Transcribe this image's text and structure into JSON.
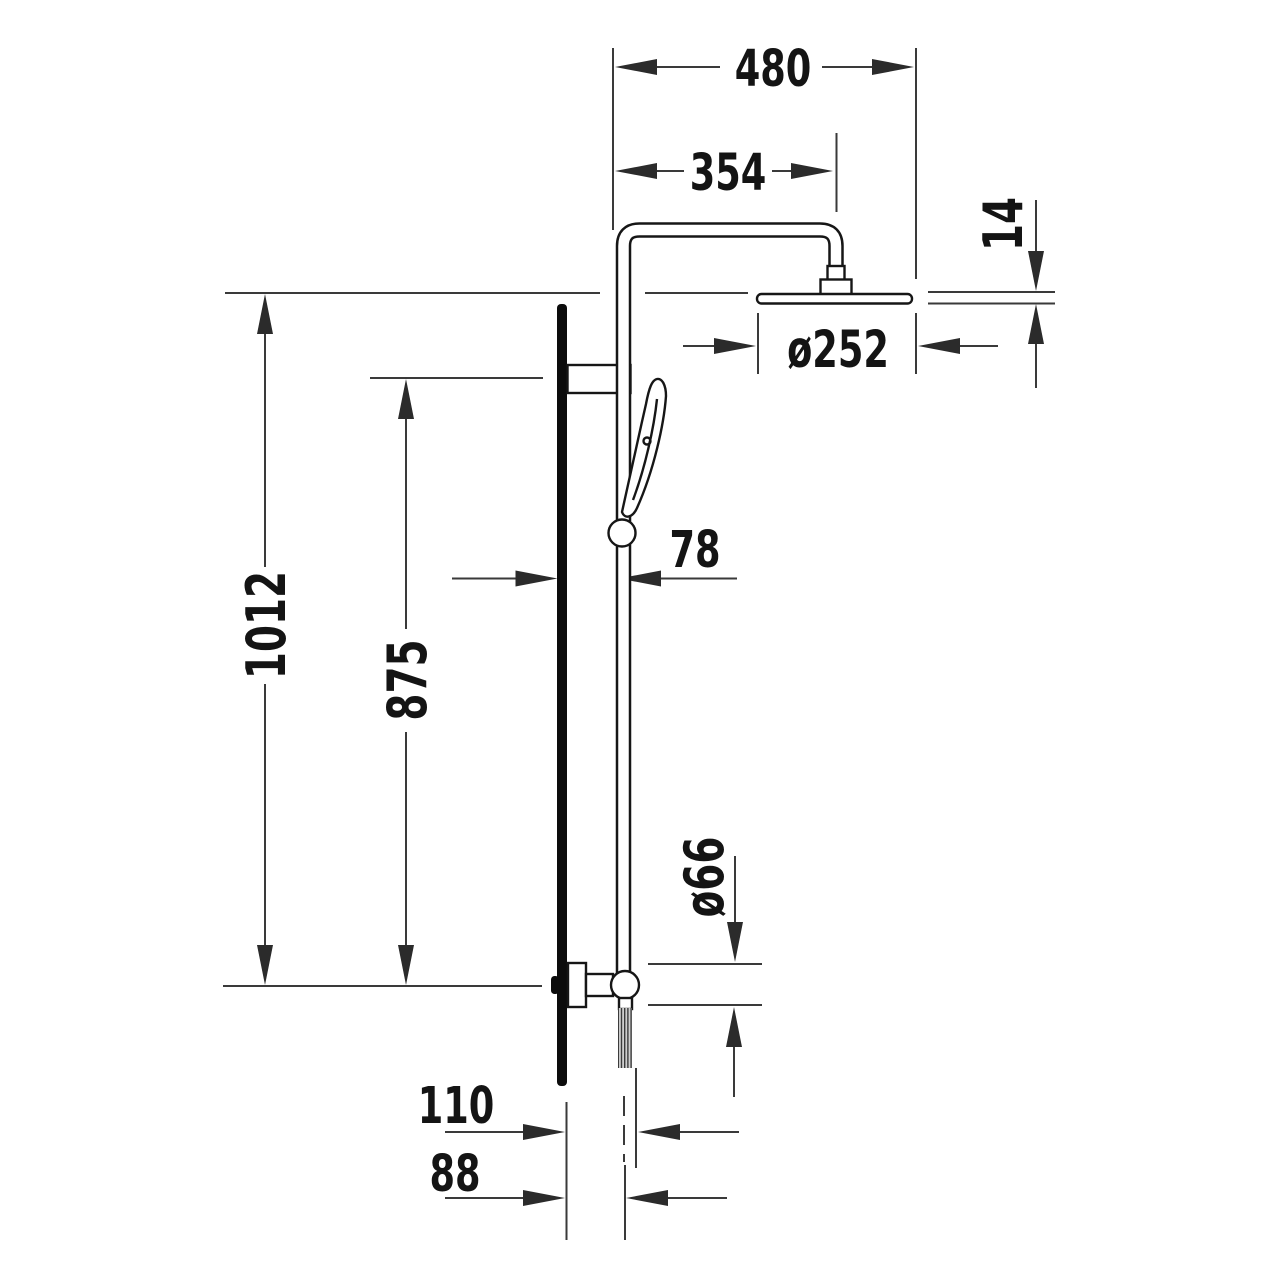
{
  "drawing": {
    "kind": "technical-dimension-drawing",
    "subject": "shower-column-side-elevation",
    "background_color": "#ffffff",
    "line_color": "#3a3a3a",
    "part_color": "#161616",
    "dimensions": {
      "overall_width": "480",
      "arm_projection": "354",
      "head_thickness": "14",
      "head_diameter": "ø252",
      "wall_to_rail": "78",
      "overall_height": "1012",
      "rail_height": "875",
      "valve_diameter": "ø66",
      "bottom_offset_outer": "110",
      "bottom_offset_inner": "88"
    }
  }
}
